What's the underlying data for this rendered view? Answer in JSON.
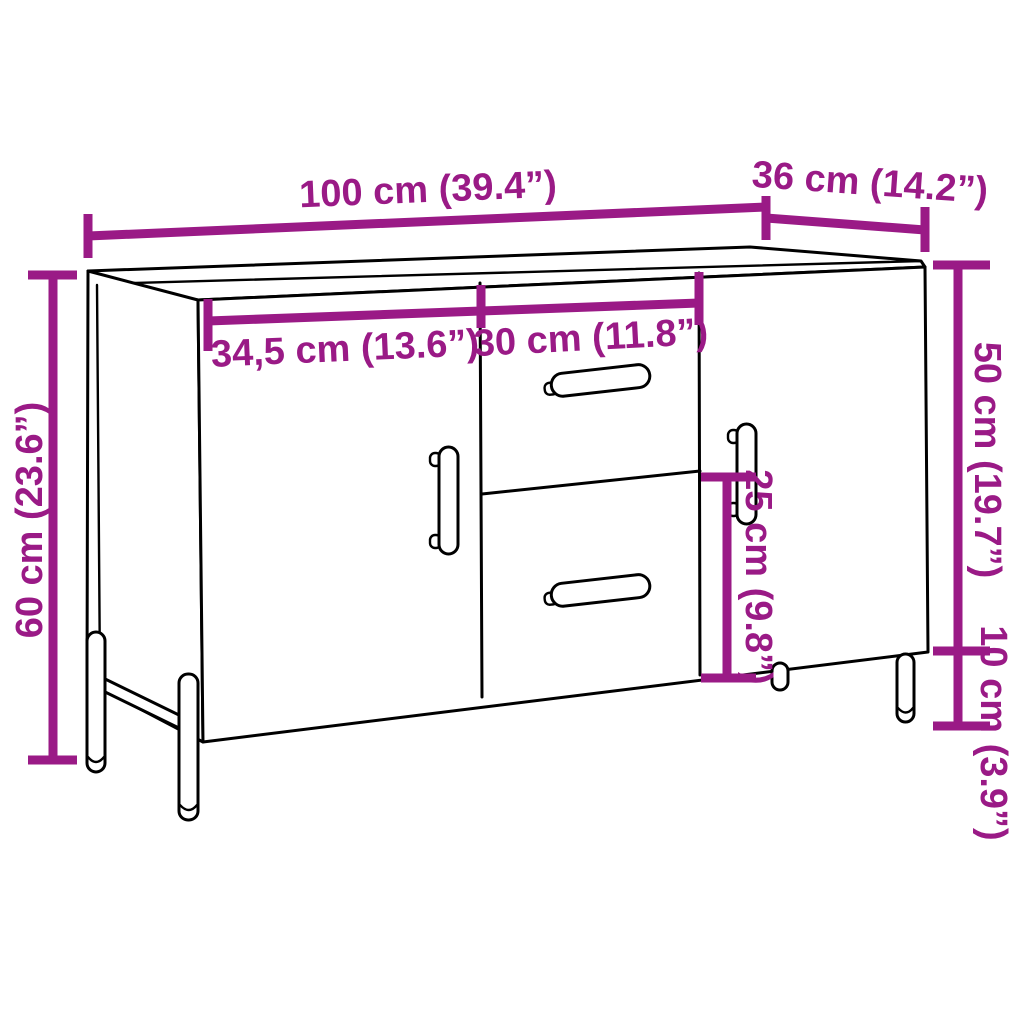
{
  "diagram": {
    "kind": "furniture-dimension-diagram",
    "colors": {
      "dimension": "#9A1A86",
      "outline": "#000000",
      "background": "#FFFFFF"
    },
    "dimensions": {
      "overall_width": "100 cm (39.4”)",
      "depth": "36 cm (14.2”)",
      "left_door_width": "34,5 cm (13.6”)",
      "drawer_width": "30 cm (11.8”)",
      "overall_height": "60 cm (23.6”)",
      "body_height": "50 cm (19.7”)",
      "lower_drawer_height": "25 cm (9.8”)",
      "leg_height": "10 cm (3.9”)"
    }
  }
}
